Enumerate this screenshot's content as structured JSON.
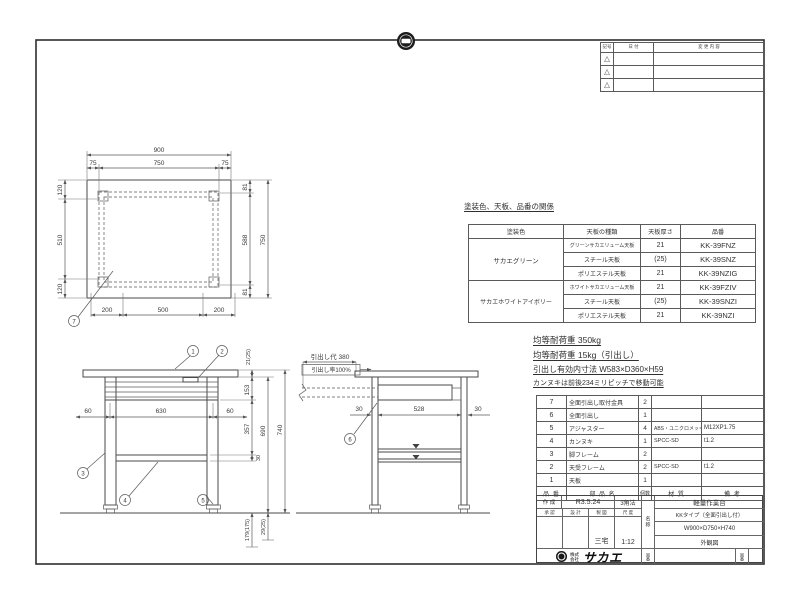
{
  "revision_table": {
    "col_symbol": "記号",
    "col_date": "日 付",
    "col_desc": "変 更 内 容",
    "symbol": "△"
  },
  "top_view": {
    "d900": "900",
    "d75_left": "75",
    "d750_top": "750",
    "d75_right": "75",
    "d120_top": "120",
    "d510": "510",
    "d120_bottom": "120",
    "d81_top": "81",
    "d588": "588",
    "d81_bottom": "81",
    "d750_right": "750",
    "d200_left": "200",
    "d500": "500",
    "d200_right": "200",
    "balloon7": "7"
  },
  "front_view": {
    "balloon1": "1",
    "balloon2": "2",
    "balloon3": "3",
    "balloon4": "4",
    "balloon5": "5",
    "d21": "21(25)",
    "d153": "153",
    "d60_left": "60",
    "d630": "630",
    "d60_right": "60",
    "d357": "357",
    "d30": "30",
    "d690": "690",
    "d740": "740",
    "d29": "29(25)",
    "d179": "179(175)"
  },
  "side_view": {
    "balloon6": "6",
    "stroke_label": "引出し代 380",
    "rate_label": "引出し率100%",
    "d30_left": "30",
    "d528": "528",
    "d30_right": "30"
  },
  "finish_table": {
    "title": "塗装色、天板、品番の関係",
    "headers": [
      "塗装色",
      "天板の種類",
      "天板厚さ",
      "品番"
    ],
    "groups": [
      {
        "label": "サカエグリーン"
      },
      {
        "label": "サカエホワイトアイボリー"
      }
    ],
    "rows": [
      {
        "type": "グリーンサカエリューム天板",
        "thickness": "21",
        "part": "KK-39FNZ"
      },
      {
        "type": "スチール天板",
        "thickness": "(25)",
        "part": "KK-39SNZ"
      },
      {
        "type": "ポリエステル天板",
        "thickness": "21",
        "part": "KK-39NZIG"
      },
      {
        "type": "ホワイトサカエリューム天板",
        "thickness": "21",
        "part": "KK-39FZIV"
      },
      {
        "type": "スチール天板",
        "thickness": "(25)",
        "part": "KK-39SNZI"
      },
      {
        "type": "ポリエステル天板",
        "thickness": "21",
        "part": "KK-39NZI"
      }
    ]
  },
  "notes": [
    "均等耐荷重 350kg",
    "均等耐荷重 15kg（引出し）",
    "引出し有効内寸法 W583×D360×H59",
    "カンヌキは前後234ミリピッチで移動可能"
  ],
  "parts_list": {
    "headers": {
      "no": "品 番",
      "name": "部 品 名",
      "qty": "個数",
      "material": "材 質",
      "remarks": "備 考"
    },
    "rows": [
      {
        "no": "7",
        "name": "全面引出し取付金具",
        "qty": "2",
        "material": "",
        "remarks": ""
      },
      {
        "no": "6",
        "name": "全面引出し",
        "qty": "1",
        "material": "",
        "remarks": ""
      },
      {
        "no": "5",
        "name": "アジャスター",
        "qty": "4",
        "material": "ABS・ユニクロメッキ",
        "remarks": "M12XP1.75"
      },
      {
        "no": "4",
        "name": "カンヌキ",
        "qty": "1",
        "material": "SPCC-SD",
        "remarks": "t1.2"
      },
      {
        "no": "3",
        "name": "脚フレーム",
        "qty": "2",
        "material": "",
        "remarks": ""
      },
      {
        "no": "2",
        "name": "天受フレーム",
        "qty": "2",
        "material": "SPCC-SD",
        "remarks": "t1.2"
      },
      {
        "no": "1",
        "name": "天板",
        "qty": "1",
        "material": "",
        "remarks": ""
      }
    ]
  },
  "title_block": {
    "created_label": "作 成",
    "created_date": "R3.5.24",
    "projection": "3角法",
    "approval_label": "承 認",
    "design_label": "設 計",
    "draft_label": "製 図",
    "scale_label": "尺 度",
    "drafter": "三宅",
    "scale": "1:12",
    "name_label": "名称",
    "product_name": "軽量作業台",
    "product_type": "KKタイプ（全面引出し付）",
    "product_size": "W900×D750×H740",
    "drawing_type": "外観図",
    "company_prefix": "株式会社",
    "company_name": "サカエ",
    "drawing_no_label": "図番"
  }
}
